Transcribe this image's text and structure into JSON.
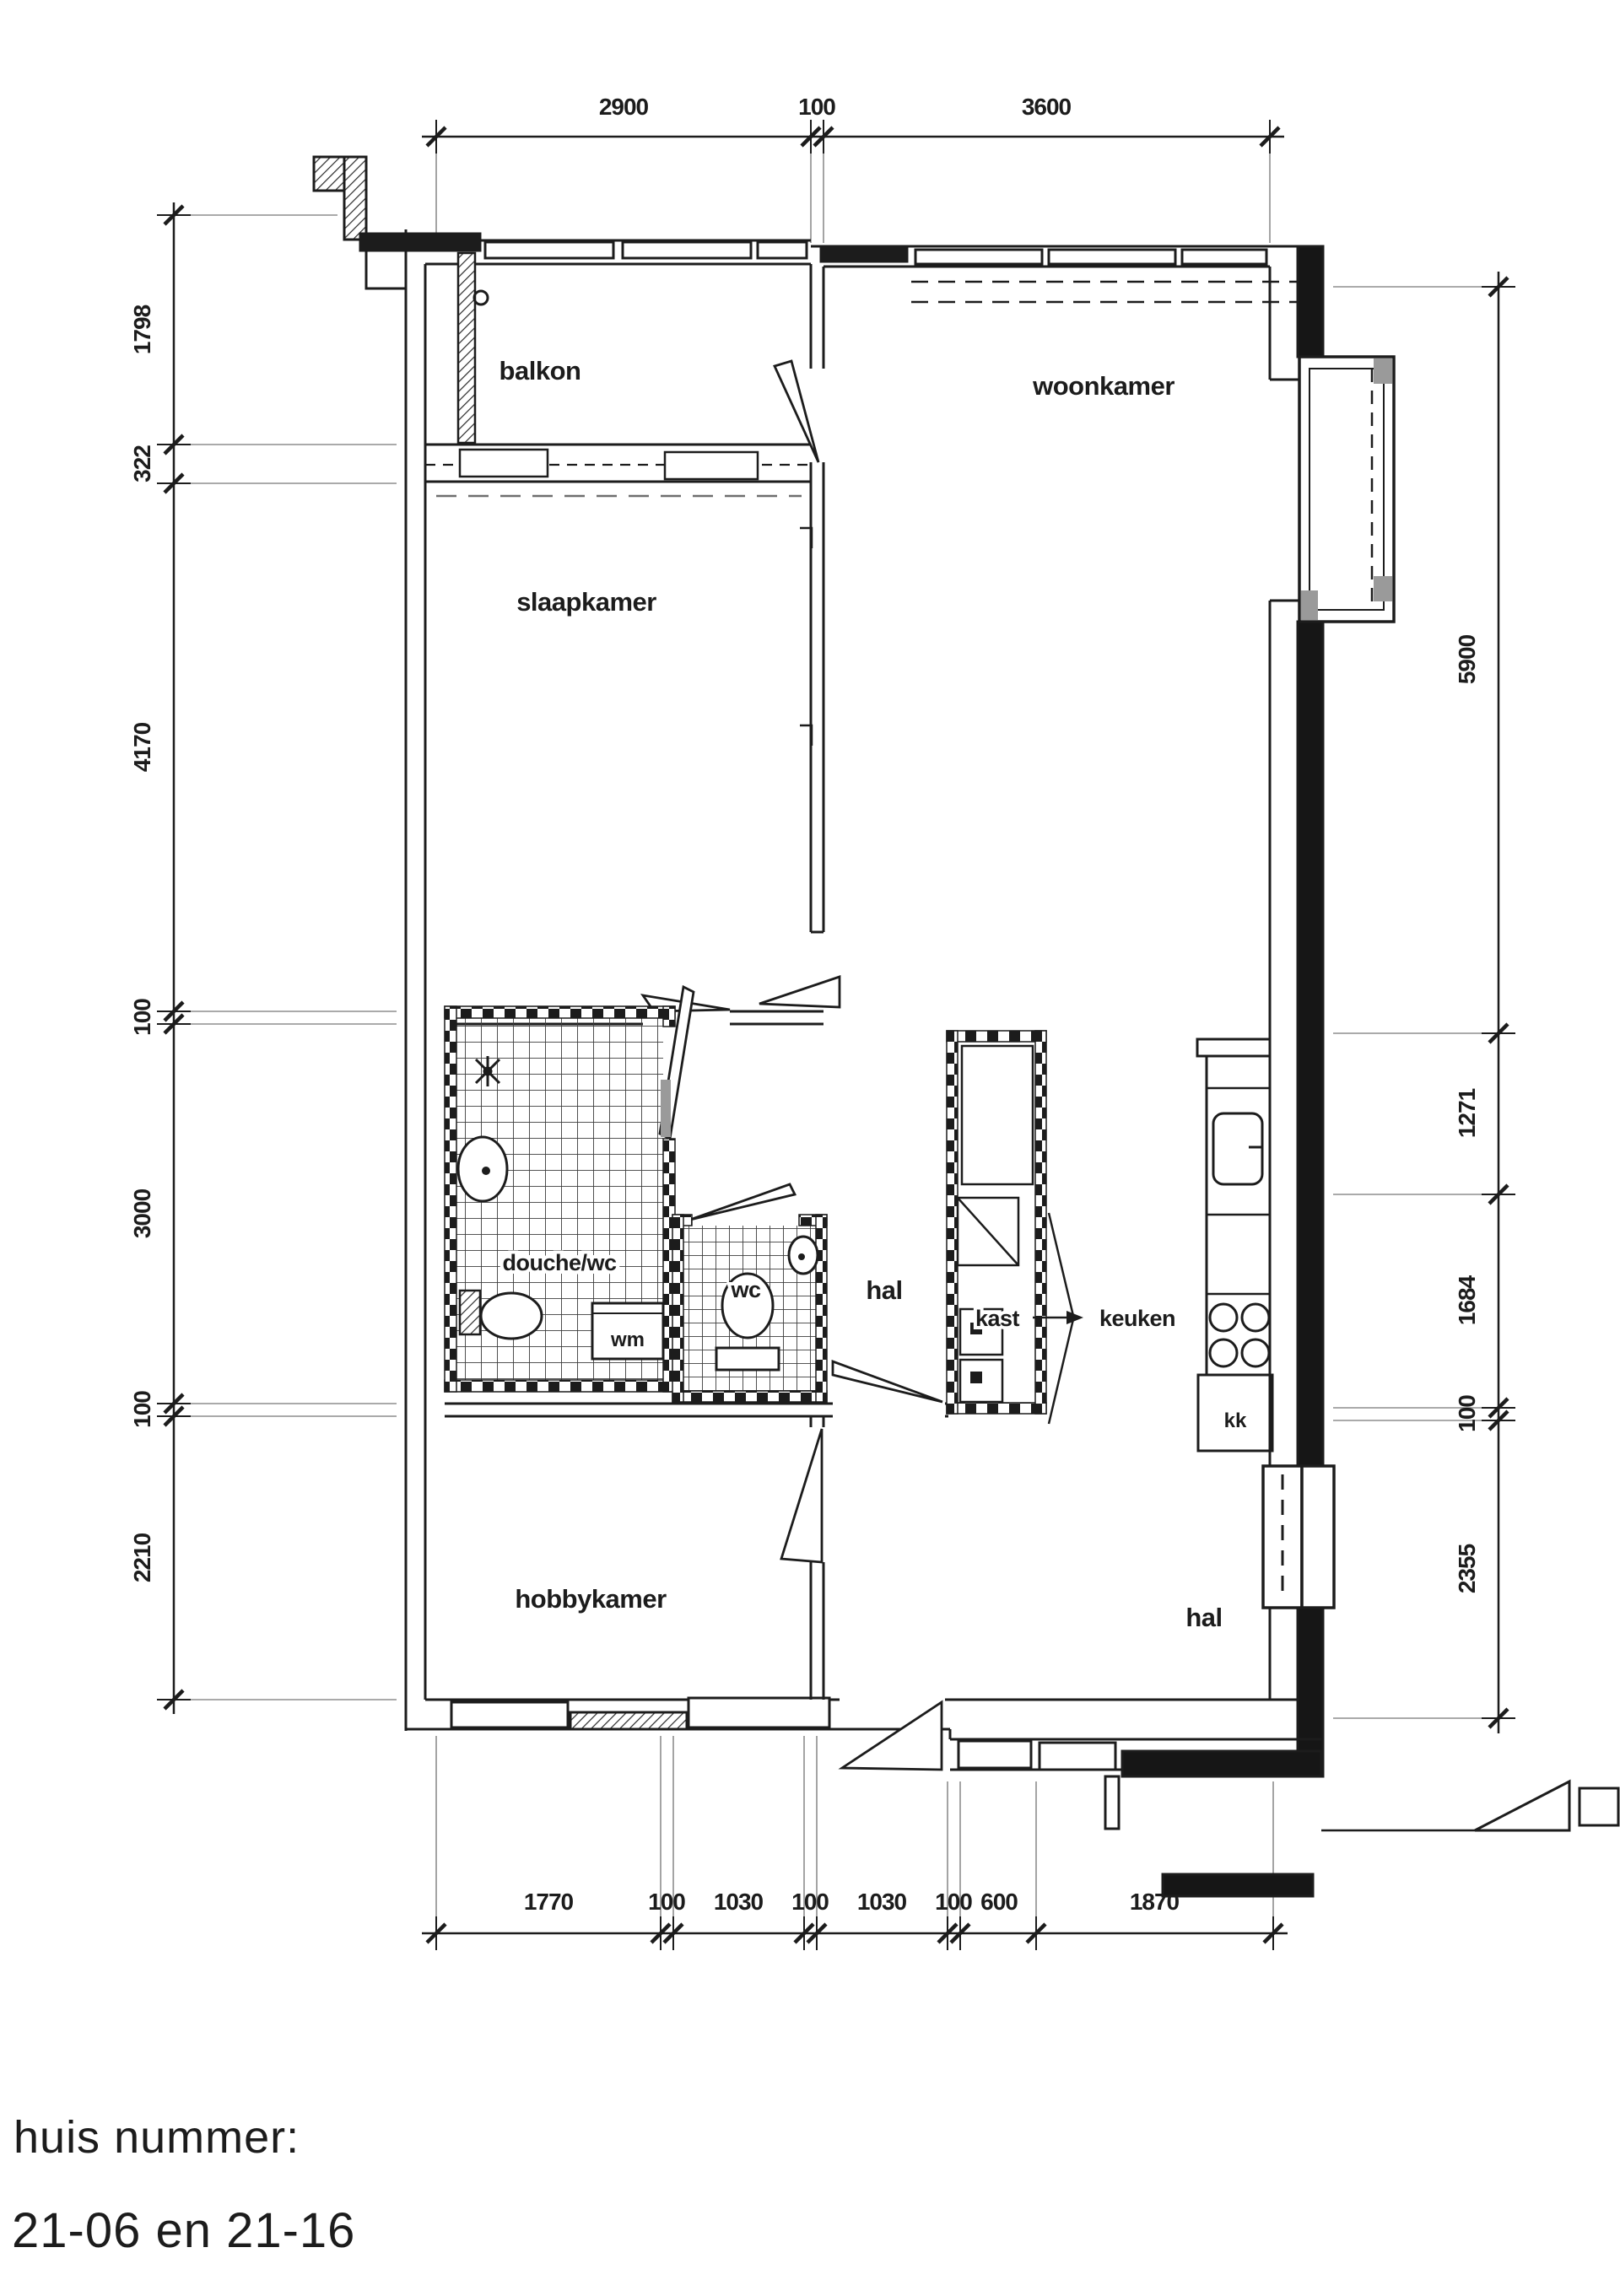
{
  "footer": {
    "line1": "huis nummer:",
    "line2": "21-06 en 21-16"
  },
  "rooms": {
    "balkon": "balkon",
    "woonkamer": "woonkamer",
    "slaapkamer": "slaapkamer",
    "douche_wc": "douche/wc",
    "wc": "wc",
    "hal_mid": "hal",
    "kast": "kast",
    "keuken": "keuken",
    "hobbykamer": "hobbykamer",
    "hal_bottom": "hal"
  },
  "fixtures": {
    "wm": "wm",
    "kk": "kk"
  },
  "dimensions": {
    "top": [
      "2900",
      "100",
      "3600"
    ],
    "bottom": [
      "1770",
      "100",
      "1030",
      "100",
      "1030",
      "100",
      "600",
      "1870"
    ],
    "left": [
      "1798",
      "322",
      "4170",
      "100",
      "3000",
      "100",
      "2210"
    ],
    "right": [
      "5900",
      "1271",
      "1684",
      "100",
      "2355"
    ]
  },
  "colors": {
    "ink": "#1c1c1c",
    "paper": "#ffffff",
    "shade": "#9a9a9a"
  }
}
